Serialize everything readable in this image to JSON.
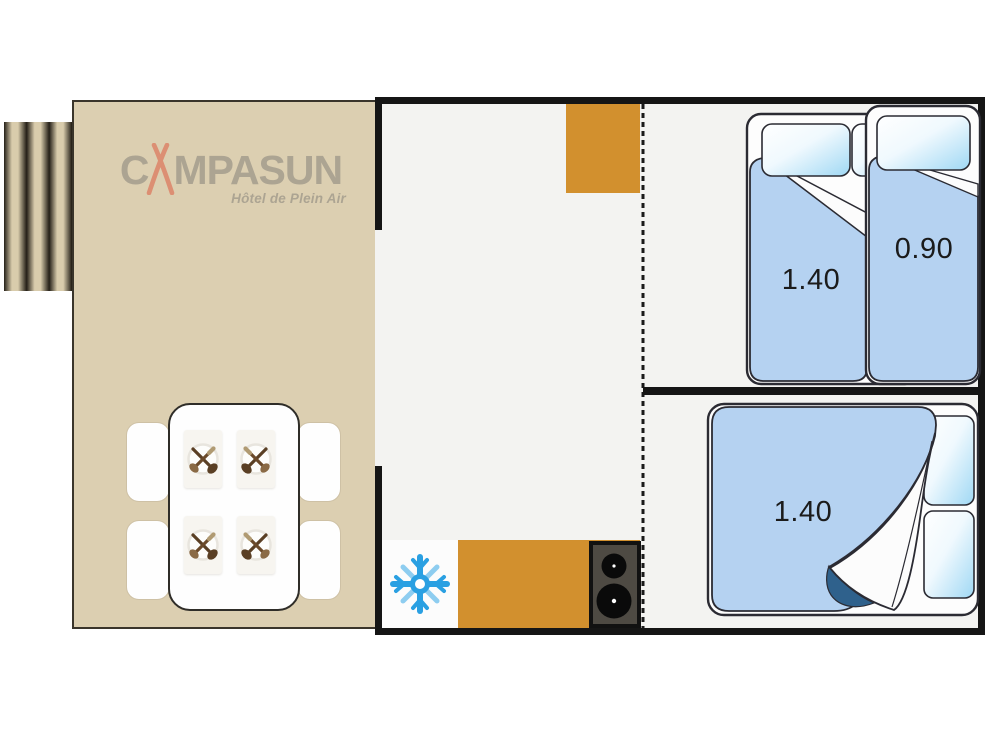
{
  "logo": {
    "prefix": "C",
    "suffix": "MPASUN",
    "tagline": "Hôtel de Plein Air",
    "mark": "tipi-icon",
    "text_color": "#969084",
    "mark_color": "#dd7157"
  },
  "plan": {
    "colors": {
      "terrace_beige": "#dccfb1",
      "steps_beige": "#d9ccac",
      "wall_black": "#151515",
      "floor": "#f3f3f1",
      "cabinet_orange": "#d2902e",
      "bed_blue": "#b5d2f1",
      "bed_outline": "#2b2b33",
      "fold_navy": "#2f618c",
      "snowflake_blue": "#2aa0e2",
      "stove_gray": "#4e4a43"
    },
    "rooms": {
      "terrace": {
        "items": [
          "dining-table",
          "chair",
          "chair",
          "chair",
          "chair",
          "place-setting x4 (crossed-cutlery-icon)"
        ]
      },
      "living_kitchen": {
        "items": [
          "wardrobe-cabinet",
          "fridge (snowflake-icon)",
          "kitchen-counter",
          "stove (2 burners)"
        ],
        "partition": "dashed-line"
      },
      "bedroom_top": {
        "beds": [
          {
            "type": "double",
            "label": "1.40"
          },
          {
            "type": "single",
            "label": "0.90"
          }
        ]
      },
      "bedroom_bottom": {
        "beds": [
          {
            "type": "double",
            "label": "1.40"
          }
        ]
      }
    }
  }
}
